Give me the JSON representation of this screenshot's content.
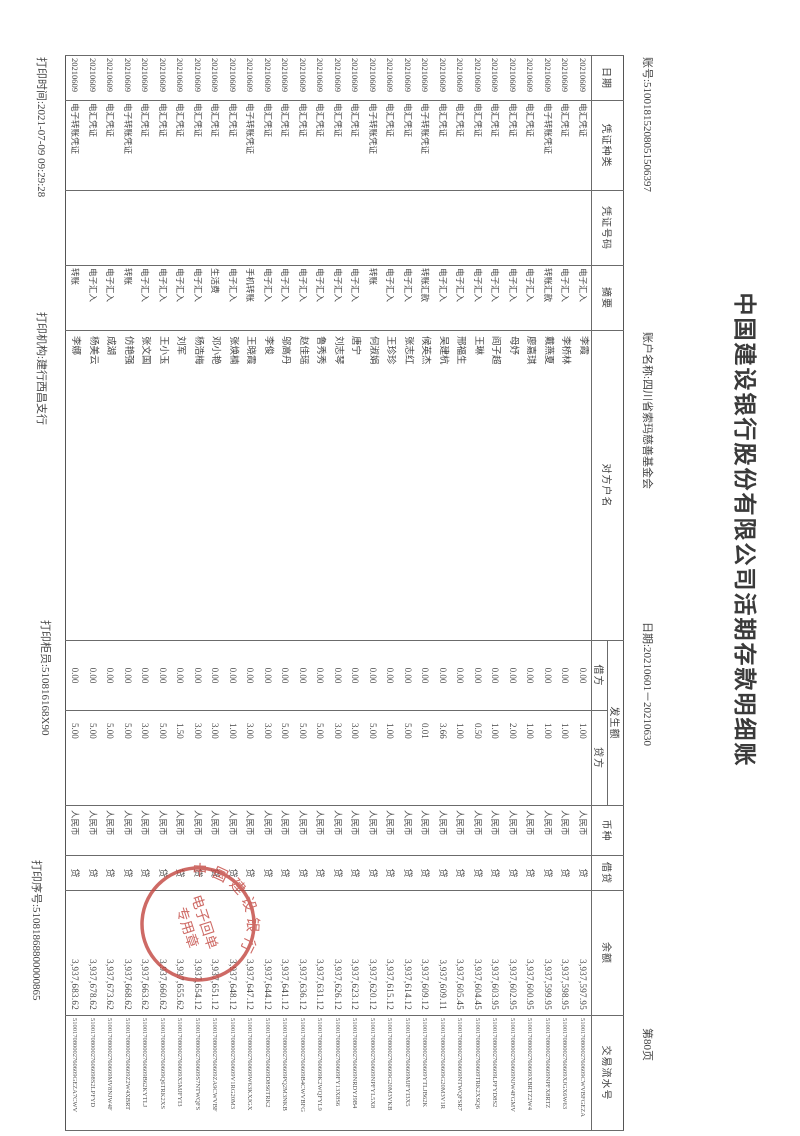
{
  "header": {
    "title": "中国建设银行股份有限公司活期存款明细账",
    "account_no": "账号:51001815208051506397",
    "account_name": "账户名称:四川省索玛慈善基金会",
    "date_range": "日期:20210601－20210630",
    "page_no": "第80页"
  },
  "table": {
    "col_headers": {
      "date": "日期",
      "voucher_type": "凭证种类",
      "voucher_no": "凭证号码",
      "summary": "摘要",
      "counterparty": "对方户名",
      "amount_group": "发生额",
      "debit": "借方",
      "credit": "贷方",
      "currency": "币种",
      "dr_cr": "借贷",
      "balance": "余额",
      "serial": "交易流水号"
    },
    "rows": [
      {
        "date": "20210609",
        "voucher_type": "电汇凭证",
        "voucher_no": "",
        "summary": "电子汇入",
        "counterparty": "李霞",
        "debit": "0.00",
        "credit": "1.00",
        "currency": "人民币",
        "dr_cr": "贷",
        "balance": "3,937,597.95",
        "serial": "510017080002760609CWVBFGEZA"
      },
      {
        "date": "20210609",
        "voucher_type": "电汇凭证",
        "voucher_no": "",
        "summary": "电子汇入",
        "counterparty": "李桥林",
        "debit": "0.00",
        "credit": "1.00",
        "currency": "人民币",
        "dr_cr": "贷",
        "balance": "3,937,598.95",
        "serial": "510017080002760609XJGX6W63"
      },
      {
        "date": "20210609",
        "voucher_type": "电子转账凭证",
        "voucher_no": "",
        "summary": "转账汇款",
        "counterparty": "戴燕夏",
        "debit": "0.00",
        "credit": "1.00",
        "currency": "人民币",
        "dr_cr": "贷",
        "balance": "3,937,599.95",
        "serial": "510017080002760609NPFX8RTZ"
      },
      {
        "date": "20210609",
        "voucher_type": "电汇凭证",
        "voucher_no": "",
        "summary": "电子汇入",
        "counterparty": "廖嘉琪",
        "debit": "0.00",
        "credit": "1.00",
        "currency": "人民币",
        "dr_cr": "贷",
        "balance": "3,937,600.95",
        "serial": "510017080002760609XBRTZ2W4"
      },
      {
        "date": "20210609",
        "voucher_type": "电汇凭证",
        "voucher_no": "",
        "summary": "电子汇入",
        "counterparty": "母妤",
        "debit": "0.00",
        "credit": "2.00",
        "currency": "人民币",
        "dr_cr": "贷",
        "balance": "3,937,602.95",
        "serial": "510017080002760609NJW4FGMV"
      },
      {
        "date": "20210609",
        "voucher_type": "电汇凭证",
        "voucher_no": "",
        "summary": "电子汇入",
        "counterparty": "阎子超",
        "debit": "0.00",
        "credit": "1.00",
        "currency": "人民币",
        "dr_cr": "贷",
        "balance": "3,937,603.95",
        "serial": "510017080002760609LPFYD8S2"
      },
      {
        "date": "20210609",
        "voucher_type": "电汇凭证",
        "voucher_no": "",
        "summary": "电子汇入",
        "counterparty": "王琳",
        "debit": "0.00",
        "credit": "0.50",
        "currency": "人民币",
        "dr_cr": "贷",
        "balance": "3,937,604.45",
        "serial": "510017080002760609TRK2XSQ6"
      },
      {
        "date": "20210609",
        "voucher_type": "电汇凭证",
        "voucher_no": "",
        "summary": "电子汇入",
        "counterparty": "邢福生",
        "debit": "0.00",
        "credit": "1.00",
        "currency": "人民币",
        "dr_cr": "贷",
        "balance": "3,937,605.45",
        "serial": "510017080002760609NTWQFSR7"
      },
      {
        "date": "20210609",
        "voucher_type": "电汇凭证",
        "voucher_no": "",
        "summary": "电子汇入",
        "counterparty": "吴建杭",
        "debit": "0.00",
        "credit": "3.66",
        "currency": "人民币",
        "dr_cr": "贷",
        "balance": "3,937,609.11",
        "serial": "510017080002760609G20M3V1R"
      },
      {
        "date": "20210609",
        "voucher_type": "电子转账凭证",
        "voucher_no": "",
        "summary": "转账汇款",
        "counterparty": "候英杰",
        "debit": "0.00",
        "credit": "0.01",
        "currency": "人民币",
        "dr_cr": "贷",
        "balance": "3,937,609.12",
        "serial": "510017080002760609YTLJB62K"
      },
      {
        "date": "20210609",
        "voucher_type": "电汇凭证",
        "voucher_no": "",
        "summary": "电子汇入",
        "counterparty": "张志红",
        "debit": "0.00",
        "credit": "5.00",
        "currency": "人民币",
        "dr_cr": "贷",
        "balance": "3,937,614.12",
        "serial": "510017080002760609MJFYI3X5"
      },
      {
        "date": "20210609",
        "voucher_type": "电汇凭证",
        "voucher_no": "",
        "summary": "电子汇入",
        "counterparty": "王珍珍",
        "debit": "0.00",
        "credit": "1.00",
        "currency": "人民币",
        "dr_cr": "贷",
        "balance": "3,937,615.12",
        "serial": "510017080002760609G20M3VKB"
      },
      {
        "date": "20210609",
        "voucher_type": "电子转账凭证",
        "voucher_no": "",
        "summary": "转账",
        "counterparty": "何淑娟",
        "debit": "0.00",
        "credit": "5.00",
        "currency": "人民币",
        "dr_cr": "贷",
        "balance": "3,937,620.12",
        "serial": "510017080002760609NPFYL5X8"
      },
      {
        "date": "20210609",
        "voucher_type": "电汇凭证",
        "voucher_no": "",
        "summary": "电子汇入",
        "counterparty": "唐宁",
        "debit": "0.00",
        "credit": "3.00",
        "currency": "人民币",
        "dr_cr": "贷",
        "balance": "3,937,623.12",
        "serial": "510017080002760609NRDYJ9B4"
      },
      {
        "date": "20210609",
        "voucher_type": "电汇凭证",
        "voucher_no": "",
        "summary": "电子汇入",
        "counterparty": "刘志琴",
        "debit": "0.00",
        "credit": "3.00",
        "currency": "人民币",
        "dr_cr": "贷",
        "balance": "3,937,626.12",
        "serial": "510017080002760609FY13X8S6"
      },
      {
        "date": "20210609",
        "voucher_type": "电汇凭证",
        "voucher_no": "",
        "summary": "电子汇入",
        "counterparty": "鲁秀秀",
        "debit": "0.00",
        "credit": "5.00",
        "currency": "人民币",
        "dr_cr": "贷",
        "balance": "3,937,631.12",
        "serial": "510017080002760609K2WQFYL9"
      },
      {
        "date": "20210609",
        "voucher_type": "电汇凭证",
        "voucher_no": "",
        "summary": "电子汇入",
        "counterparty": "赵佳瑶",
        "debit": "0.00",
        "credit": "5.00",
        "currency": "人民币",
        "dr_cr": "贷",
        "balance": "3,937,636.12",
        "serial": "510017080002760609B4CWVBFG"
      },
      {
        "date": "20210609",
        "voucher_type": "电汇凭证",
        "voucher_no": "",
        "summary": "电子汇入",
        "counterparty": "邬高丹",
        "debit": "0.00",
        "credit": "5.00",
        "currency": "人民币",
        "dr_cr": "贷",
        "balance": "3,937,641.12",
        "serial": "510017080002760609PQ2M3NKB"
      },
      {
        "date": "20210609",
        "voucher_type": "电汇凭证",
        "voucher_no": "",
        "summary": "电子汇入",
        "counterparty": "李俊",
        "debit": "0.00",
        "credit": "3.00",
        "currency": "人民币",
        "dr_cr": "贷",
        "balance": "3,937,644.12",
        "serial": "510017080002760609D8S6TRK2"
      },
      {
        "date": "20210609",
        "voucher_type": "电子转账凭证",
        "voucher_no": "",
        "summary": "手机转账",
        "counterparty": "王晓霞",
        "debit": "0.00",
        "credit": "3.00",
        "currency": "人民币",
        "dr_cr": "贷",
        "balance": "3,937,647.12",
        "serial": "510017080002760609W63KXJGX"
      },
      {
        "date": "20210609",
        "voucher_type": "电汇凭证",
        "voucher_no": "",
        "summary": "电子汇入",
        "counterparty": "张焕楠",
        "debit": "0.00",
        "credit": "1.00",
        "currency": "人民币",
        "dr_cr": "贷",
        "balance": "3,937,648.12",
        "serial": "510017080002760609V1RG20M3"
      },
      {
        "date": "20210609",
        "voucher_type": "电汇凭证",
        "voucher_no": "",
        "summary": "生活费",
        "counterparty": "邓小艳",
        "debit": "0.00",
        "credit": "3.00",
        "currency": "人民币",
        "dr_cr": "贷",
        "balance": "3,937,651.12",
        "serial": "510017080002760609ZA9CWVBF"
      },
      {
        "date": "20210609",
        "voucher_type": "电汇凭证",
        "voucher_no": "",
        "summary": "电子汇入",
        "counterparty": "杨浩梅",
        "debit": "0.00",
        "credit": "3.00",
        "currency": "人民币",
        "dr_cr": "贷",
        "balance": "3,937,654.12",
        "serial": "510017080002760609S7NTWQFS"
      },
      {
        "date": "20210609",
        "voucher_type": "电汇凭证",
        "voucher_no": "",
        "summary": "电子汇入",
        "counterparty": "刘军",
        "debit": "0.00",
        "credit": "1.50",
        "currency": "人民币",
        "dr_cr": "贷",
        "balance": "3,937,655.62",
        "serial": "510017080002760609X5MJFYI3"
      },
      {
        "date": "20210609",
        "voucher_type": "电汇凭证",
        "voucher_no": "",
        "summary": "电子汇入",
        "counterparty": "王小玉",
        "debit": "0.00",
        "credit": "5.00",
        "currency": "人民币",
        "dr_cr": "贷",
        "balance": "3,937,660.62",
        "serial": "510017080002760609Q6TRK2XS"
      },
      {
        "date": "20210609",
        "voucher_type": "电汇凭证",
        "voucher_no": "",
        "summary": "电子汇入",
        "counterparty": "张文国",
        "debit": "0.00",
        "credit": "3.00",
        "currency": "人民币",
        "dr_cr": "贷",
        "balance": "3,937,663.62",
        "serial": "510017080002760609B62KYTLJ"
      },
      {
        "date": "20210609",
        "voucher_type": "电子转账凭证",
        "voucher_no": "",
        "summary": "转账",
        "counterparty": "仿艳强",
        "debit": "0.00",
        "credit": "5.00",
        "currency": "人民币",
        "dr_cr": "贷",
        "balance": "3,937,668.62",
        "serial": "510017080002760609Z2W4XBRT"
      },
      {
        "date": "20210609",
        "voucher_type": "电汇凭证",
        "voucher_no": "",
        "summary": "电子汇入",
        "counterparty": "成湖",
        "debit": "0.00",
        "credit": "5.00",
        "currency": "人民币",
        "dr_cr": "贷",
        "balance": "3,937,673.62",
        "serial": "510017080002760609MV8NJW4F"
      },
      {
        "date": "20210609",
        "voucher_type": "电汇凭证",
        "voucher_no": "",
        "summary": "电子汇入",
        "counterparty": "杨美云",
        "debit": "0.00",
        "credit": "5.00",
        "currency": "人民币",
        "dr_cr": "贷",
        "balance": "3,937,678.62",
        "serial": "5100170800027606098S2LPFYD"
      },
      {
        "date": "20210609",
        "voucher_type": "电子转账凭证",
        "voucher_no": "",
        "summary": "转账",
        "counterparty": "李娜",
        "debit": "0.00",
        "credit": "5.00",
        "currency": "人民币",
        "dr_cr": "贷",
        "balance": "3,937,683.62",
        "serial": "510017080002760609GEZA7CWV"
      }
    ]
  },
  "footer": {
    "print_time": "打印时间:2021-07-09 09:29:28",
    "print_branch": "打印机构:建行西昌支行",
    "print_teller": "打印柜员:510816168X90",
    "print_serial": "打印序号:51081868800000865"
  },
  "seal": {
    "bank": "中国建设银行",
    "line1": "电子回单",
    "line2": "专用章"
  },
  "colors": {
    "seal_red": "#c2453f",
    "ink": "#3f3f3f"
  }
}
